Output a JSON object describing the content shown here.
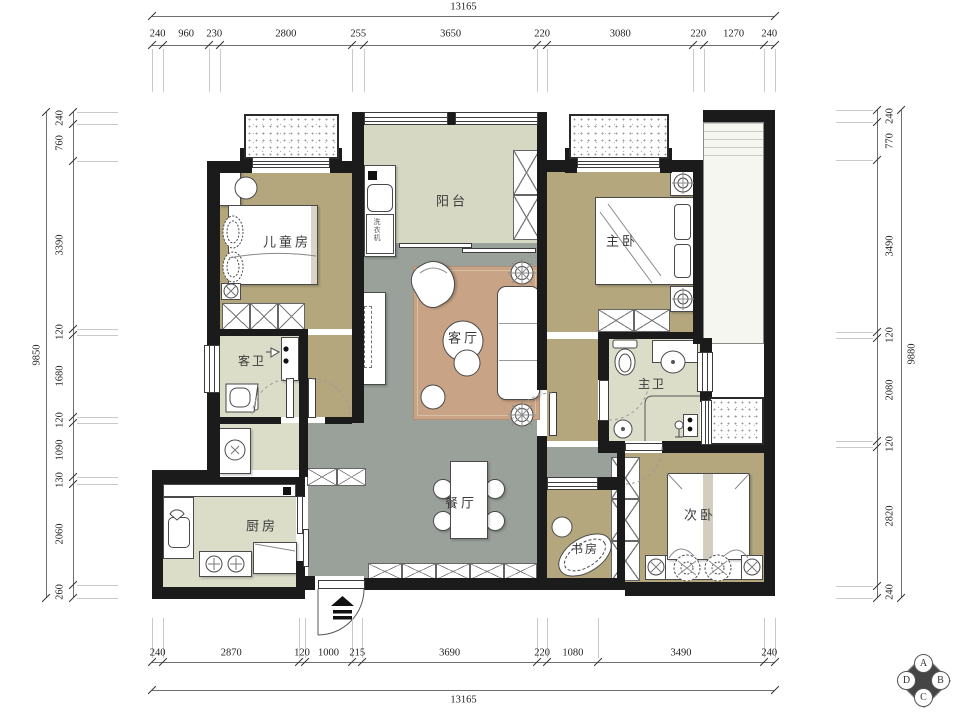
{
  "rooms": [
    {
      "id": "children_room",
      "label": "儿童房"
    },
    {
      "id": "balcony",
      "label": "阳台"
    },
    {
      "id": "master_bedroom",
      "label": "主卧"
    },
    {
      "id": "guest_bath",
      "label": "客卫"
    },
    {
      "id": "living_room",
      "label": "客厅"
    },
    {
      "id": "master_bath",
      "label": "主卫"
    },
    {
      "id": "kitchen",
      "label": "厨房"
    },
    {
      "id": "dining_room",
      "label": "餐厅"
    },
    {
      "id": "study",
      "label": "书房"
    },
    {
      "id": "second_bedroom",
      "label": "次卧"
    }
  ],
  "appliances": {
    "washing_machine": "洗衣机"
  },
  "dimensions": {
    "top": {
      "total": "13165",
      "segments": [
        "240",
        "960",
        "230",
        "2800",
        "255",
        "3650",
        "220",
        "3080",
        "220",
        "1270",
        "240"
      ]
    },
    "bottom": {
      "total": "13165",
      "segments": [
        "240",
        "2870",
        "120",
        "1000",
        "215",
        "3690",
        "220",
        "1080",
        "3490",
        "240"
      ]
    },
    "left": {
      "total": "9850",
      "segments": [
        "240",
        "760",
        "3390",
        "120",
        "1680",
        "120",
        "1090",
        "130",
        "2060",
        "260"
      ]
    },
    "right": {
      "total": "9880",
      "segments": [
        "240",
        "770",
        "3490",
        "120",
        "2080",
        "120",
        "2820",
        "240"
      ]
    }
  },
  "logo": {
    "letters": [
      "A",
      "B",
      "C",
      "D"
    ]
  },
  "colors": {
    "wall": "#1b1b1b",
    "wood_floor": "#b4a77d",
    "tile_gray": "#9aa19b",
    "tile_pale": "#dbddc9",
    "rug": "#c9a385",
    "dim_text": "#222222"
  }
}
